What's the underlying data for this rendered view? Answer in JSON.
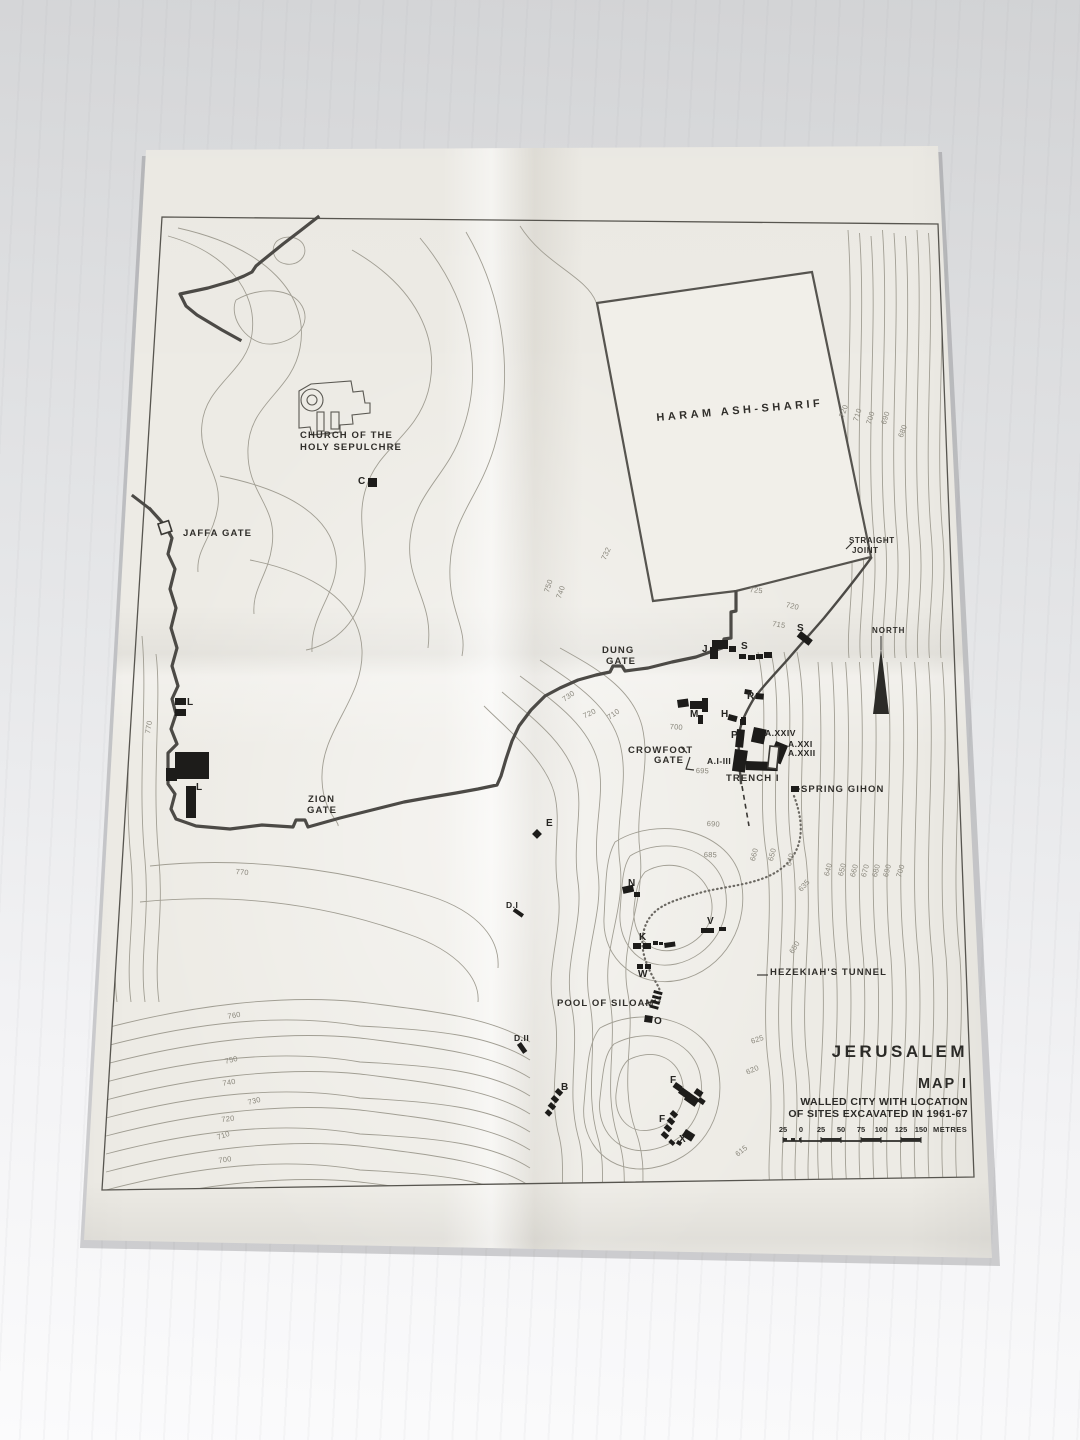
{
  "colors": {
    "paper": "#edebe5",
    "ink": "#2f2d2a",
    "wall": "#4c4a46",
    "contour_line": "#a19e93",
    "contour_label": "#8a877c",
    "marker": "#1d1c1a"
  },
  "title_block": {
    "city": "JERUSALEM",
    "map_number": "MAP I",
    "subtitle_line1": "WALLED CITY WITH LOCATION",
    "subtitle_line2": "OF SITES EXCAVATED IN 1961-67",
    "scale": {
      "ticks": [
        "25",
        "0",
        "25",
        "50",
        "75",
        "100",
        "125",
        "150"
      ],
      "unit": "METRES"
    }
  },
  "map_labels": {
    "places": [
      {
        "name": "church-of-the-holy-sepulchre-1",
        "text": "CHURCH OF THE",
        "x": 300,
        "y": 431
      },
      {
        "name": "church-of-the-holy-sepulchre-2",
        "text": "HOLY SEPULCHRE",
        "x": 300,
        "y": 443
      },
      {
        "name": "jaffa-gate",
        "text": "JAFFA GATE",
        "x": 183,
        "y": 529
      },
      {
        "name": "haram-ash-sharif",
        "text": "HARAM ASH-SHARIF",
        "x": 656,
        "y": 413,
        "rot": -5,
        "fs": 11,
        "ls": 3.5
      },
      {
        "name": "straight-joint-1",
        "text": "STRAIGHT",
        "x": 849,
        "y": 537,
        "fs": 8,
        "ls": 0.6
      },
      {
        "name": "straight-joint-2",
        "text": "JOINT",
        "x": 852,
        "y": 547,
        "fs": 8,
        "ls": 0.6
      },
      {
        "name": "dung-gate-1",
        "text": "DUNG",
        "x": 602,
        "y": 646
      },
      {
        "name": "dung-gate-2",
        "text": "GATE",
        "x": 606,
        "y": 657
      },
      {
        "name": "north",
        "text": "NORTH",
        "x": 872,
        "y": 627,
        "fs": 8,
        "ls": 1
      },
      {
        "name": "zion-gate-1",
        "text": "ZION",
        "x": 308,
        "y": 795
      },
      {
        "name": "zion-gate-2",
        "text": "GATE",
        "x": 307,
        "y": 806
      },
      {
        "name": "crowfoot-gate-1",
        "text": "CROWFOOT",
        "x": 628,
        "y": 746
      },
      {
        "name": "crowfoot-gate-2",
        "text": "GATE",
        "x": 654,
        "y": 756
      },
      {
        "name": "trench-i",
        "text": "TRENCH I",
        "x": 726,
        "y": 774
      },
      {
        "name": "spring-gihon",
        "text": "SPRING GIHON",
        "x": 801,
        "y": 785
      },
      {
        "name": "hezekiahs-tunnel",
        "text": "HEZEKIAH'S TUNNEL",
        "x": 770,
        "y": 968
      },
      {
        "name": "pool-of-siloam",
        "text": "POOL OF SILOAM",
        "x": 557,
        "y": 999
      }
    ],
    "sites": [
      {
        "text": "C",
        "x": 358,
        "y": 477
      },
      {
        "text": "L",
        "x": 187,
        "y": 698
      },
      {
        "text": "L",
        "x": 196,
        "y": 783
      },
      {
        "text": "J",
        "x": 702,
        "y": 645
      },
      {
        "text": "S",
        "x": 741,
        "y": 642
      },
      {
        "text": "S",
        "x": 797,
        "y": 624
      },
      {
        "text": "R",
        "x": 747,
        "y": 692
      },
      {
        "text": "M",
        "x": 690,
        "y": 710
      },
      {
        "text": "H",
        "x": 721,
        "y": 710
      },
      {
        "text": "P",
        "x": 731,
        "y": 731
      },
      {
        "text": "A.XXIV",
        "x": 765,
        "y": 729,
        "fs": 8.5
      },
      {
        "text": "A.XXI",
        "x": 788,
        "y": 740,
        "fs": 8.5
      },
      {
        "text": "A.XXII",
        "x": 788,
        "y": 749,
        "fs": 8.5
      },
      {
        "text": "A.I-III",
        "x": 707,
        "y": 757,
        "fs": 8.5
      },
      {
        "text": "E",
        "x": 546,
        "y": 819
      },
      {
        "text": "N",
        "x": 628,
        "y": 879
      },
      {
        "text": "V",
        "x": 707,
        "y": 917
      },
      {
        "text": "K",
        "x": 639,
        "y": 933
      },
      {
        "text": "W",
        "x": 638,
        "y": 970
      },
      {
        "text": "O",
        "x": 654,
        "y": 1017
      },
      {
        "text": "D.I",
        "x": 506,
        "y": 901,
        "fs": 8.5
      },
      {
        "text": "D.II",
        "x": 514,
        "y": 1034,
        "fs": 8.5
      },
      {
        "text": "B",
        "x": 561,
        "y": 1083
      },
      {
        "text": "F",
        "x": 670,
        "y": 1076
      },
      {
        "text": "F",
        "x": 659,
        "y": 1115
      },
      {
        "text": "X",
        "x": 679,
        "y": 1135
      }
    ],
    "contours": [
      {
        "text": "725",
        "x": 750,
        "y": 586,
        "rot": 6
      },
      {
        "text": "720",
        "x": 787,
        "y": 601,
        "rot": 14
      },
      {
        "text": "715",
        "x": 773,
        "y": 620,
        "rot": 10
      },
      {
        "text": "732",
        "x": 600,
        "y": 558,
        "rot": -65
      },
      {
        "text": "750",
        "x": 543,
        "y": 591,
        "rot": -72
      },
      {
        "text": "740",
        "x": 555,
        "y": 597,
        "rot": -70
      },
      {
        "text": "730",
        "x": 561,
        "y": 697,
        "rot": -35
      },
      {
        "text": "720",
        "x": 582,
        "y": 713,
        "rot": -25
      },
      {
        "text": "710",
        "x": 606,
        "y": 715,
        "rot": -35
      },
      {
        "text": "700",
        "x": 670,
        "y": 723,
        "rot": 4
      },
      {
        "text": "695",
        "x": 696,
        "y": 767,
        "rot": 2
      },
      {
        "text": "690",
        "x": 707,
        "y": 820,
        "rot": 3
      },
      {
        "text": "685",
        "x": 704,
        "y": 851,
        "rot": 2
      },
      {
        "text": "770",
        "x": 144,
        "y": 733,
        "rot": -80
      },
      {
        "text": "770",
        "x": 236,
        "y": 868,
        "rot": 5
      },
      {
        "text": "760",
        "x": 227,
        "y": 1013,
        "rot": -10
      },
      {
        "text": "750",
        "x": 224,
        "y": 1058,
        "rot": -14
      },
      {
        "text": "740",
        "x": 222,
        "y": 1080,
        "rot": -10
      },
      {
        "text": "730",
        "x": 247,
        "y": 1099,
        "rot": -14
      },
      {
        "text": "720",
        "x": 221,
        "y": 1116,
        "rot": -6
      },
      {
        "text": "710",
        "x": 216,
        "y": 1134,
        "rot": -18
      },
      {
        "text": "700",
        "x": 218,
        "y": 1157,
        "rot": -8
      },
      {
        "text": "720",
        "x": 838,
        "y": 416,
        "rot": -70
      },
      {
        "text": "710",
        "x": 852,
        "y": 420,
        "rot": -72
      },
      {
        "text": "700",
        "x": 865,
        "y": 423,
        "rot": -72
      },
      {
        "text": "690",
        "x": 880,
        "y": 423,
        "rot": -72
      },
      {
        "text": "680",
        "x": 897,
        "y": 436,
        "rot": -70
      },
      {
        "text": "660",
        "x": 749,
        "y": 860,
        "rot": -75
      },
      {
        "text": "650",
        "x": 767,
        "y": 860,
        "rot": -75
      },
      {
        "text": "640",
        "x": 785,
        "y": 865,
        "rot": -75
      },
      {
        "text": "635",
        "x": 797,
        "y": 888,
        "rot": -48
      },
      {
        "text": "640",
        "x": 823,
        "y": 875,
        "rot": -75
      },
      {
        "text": "650",
        "x": 837,
        "y": 875,
        "rot": -75
      },
      {
        "text": "660",
        "x": 849,
        "y": 876,
        "rot": -75
      },
      {
        "text": "670",
        "x": 860,
        "y": 876,
        "rot": -75
      },
      {
        "text": "680",
        "x": 871,
        "y": 876,
        "rot": -75
      },
      {
        "text": "690",
        "x": 882,
        "y": 876,
        "rot": -75
      },
      {
        "text": "700",
        "x": 895,
        "y": 876,
        "rot": -72
      },
      {
        "text": "650",
        "x": 788,
        "y": 951,
        "rot": -58
      },
      {
        "text": "625",
        "x": 750,
        "y": 1038,
        "rot": -18
      },
      {
        "text": "620",
        "x": 745,
        "y": 1069,
        "rot": -22
      },
      {
        "text": "615",
        "x": 734,
        "y": 1152,
        "rot": -38
      }
    ]
  }
}
